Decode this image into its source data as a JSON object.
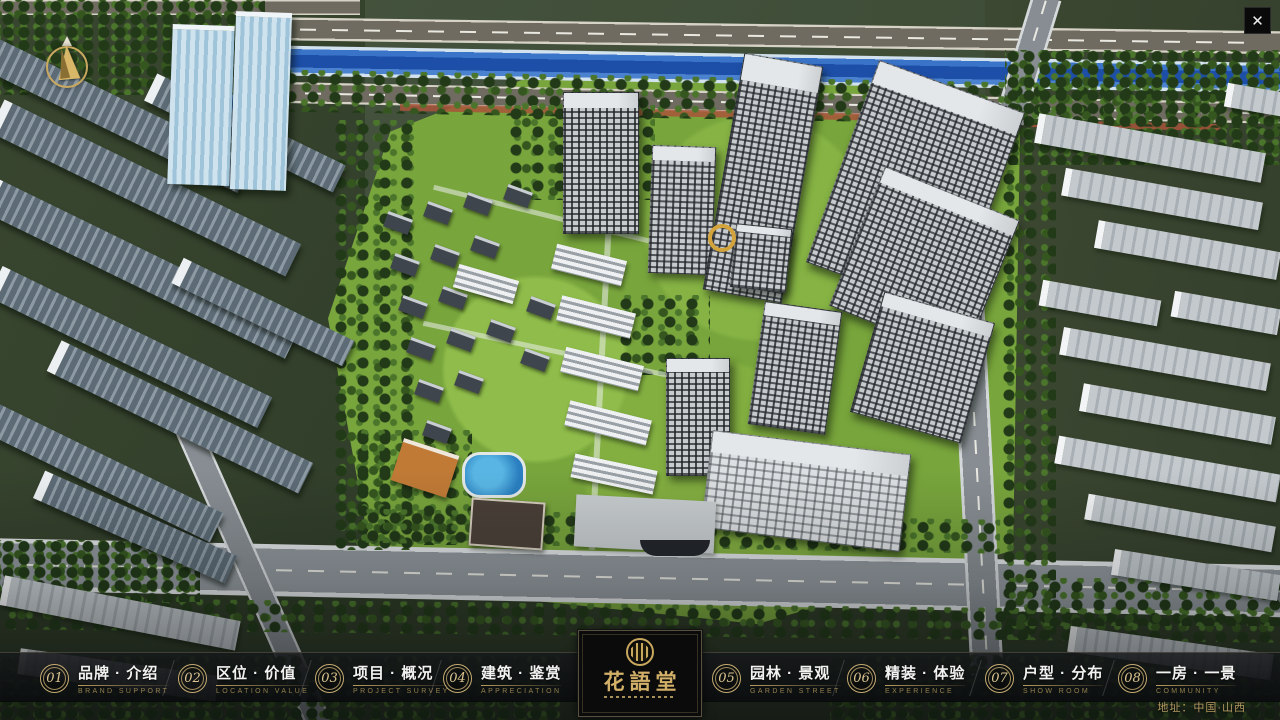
{
  "window": {
    "close_icon": "✕"
  },
  "map": {
    "address_note": "地址：中国·山西"
  },
  "logo": {
    "title": "花語堂"
  },
  "nav": {
    "items": [
      {
        "number": "01",
        "label": "品牌 · 介绍",
        "sublabel": "BRAND SUPPORT"
      },
      {
        "number": "02",
        "label": "区位 · 价值",
        "sublabel": "LOCATION VALUE"
      },
      {
        "number": "03",
        "label": "项目 · 概况",
        "sublabel": "PROJECT SURVEY"
      },
      {
        "number": "04",
        "label": "建筑 · 鉴赏",
        "sublabel": "APPRECIATION"
      },
      {
        "number": "05",
        "label": "园林 · 景观",
        "sublabel": "GARDEN STREET"
      },
      {
        "number": "06",
        "label": "精装 · 体验",
        "sublabel": "EXPERIENCE"
      },
      {
        "number": "07",
        "label": "户型 · 分布",
        "sublabel": "SHOW ROOM"
      },
      {
        "number": "08",
        "label": "一房 · 一景",
        "sublabel": "COMMUNITY"
      }
    ]
  }
}
